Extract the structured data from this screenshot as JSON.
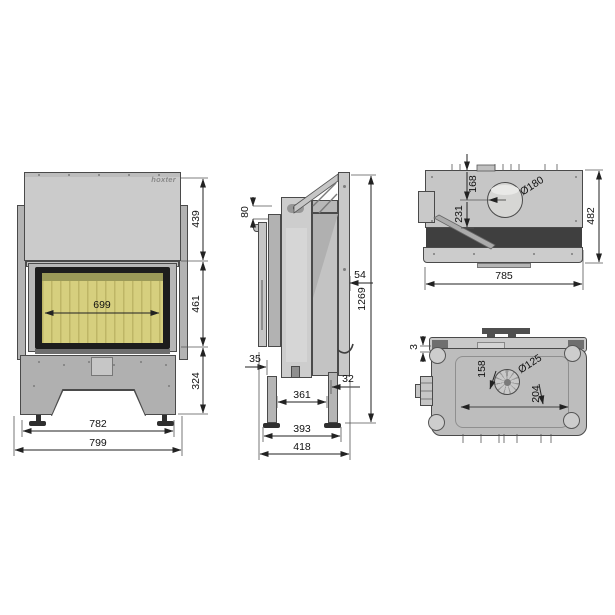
{
  "meta": {
    "drawing_type": "fireplace insert technical drawing",
    "background": "#ffffff",
    "line_color": "#222222",
    "glass_color": "#d6cf7e"
  },
  "brand": {
    "logo_text": "hoxter"
  },
  "front_view": {
    "glass_width": "699",
    "hood_height": "439",
    "glass_height": "461",
    "base_height": "324",
    "feet_span": "782",
    "total_width": "799"
  },
  "side_view": {
    "top_offset": "80",
    "rail_depth": "54",
    "total_height": "1269",
    "front_offset": "35",
    "rear_offset": "32",
    "legs_span": "361",
    "feet_span": "393",
    "total_depth": "418"
  },
  "top_view": {
    "flue_offset_1": "168",
    "flue_offset_2": "231",
    "flue_diameter": "Ø180",
    "depth": "482",
    "width": "785"
  },
  "bottom_view": {
    "panel_gap": "3",
    "inlet_offset_1": "158",
    "inlet_offset_2": "204",
    "inlet_diameter": "Ø125"
  }
}
